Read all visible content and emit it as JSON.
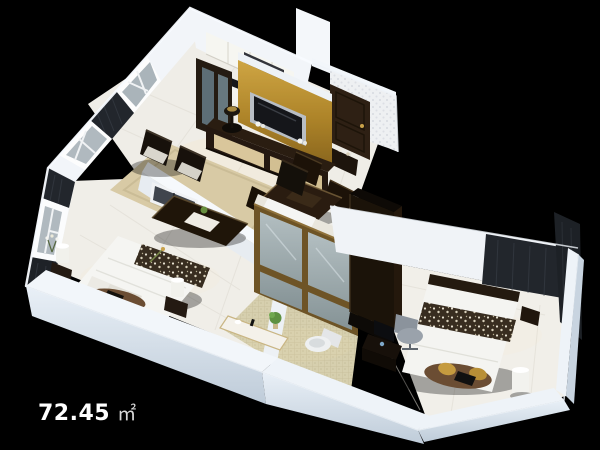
{
  "scene": {
    "kind": "3d-isometric-apartment-floorplan-render",
    "background_color": "#000000"
  },
  "area_label": {
    "value": "72.45",
    "unit": "㎡",
    "full_text": "72.45㎡"
  },
  "apartment": {
    "rooms": [
      {
        "id": "kitchen"
      },
      {
        "id": "entry-hall"
      },
      {
        "id": "living-room"
      },
      {
        "id": "dining-area"
      },
      {
        "id": "bathroom"
      },
      {
        "id": "master-bedroom"
      },
      {
        "id": "second-bedroom"
      }
    ],
    "visible_features": [
      "gold-tv-feature-wall",
      "wall-mounted-tv",
      "tv-cabinet",
      "kitchen-cabinets",
      "range-hood",
      "entry-door",
      "dining-table-with-chairs",
      "armchairs",
      "coffee-table",
      "glass-sliding-bathroom-doors",
      "bathroom-vanity",
      "toilet",
      "double-bed-master",
      "double-bed-second",
      "bedside-lamps",
      "wardrobe",
      "desk-with-monitor",
      "dark-curtains",
      "windows"
    ]
  },
  "colors": {
    "background": "#000000",
    "walls_white": "#f2f5f9",
    "plinth_face": "#cdd9e4",
    "floor_tile": "#efede7",
    "carpet_beige": "#d6c7a0",
    "gold_accent": "#b3882f",
    "dark_wood": "#241a11",
    "curtain_dark": "#22262c",
    "glass_blue_grey": "#97a8b2",
    "bathroom_mosaic": "#d6cfae",
    "label_text": "#ffffff"
  }
}
